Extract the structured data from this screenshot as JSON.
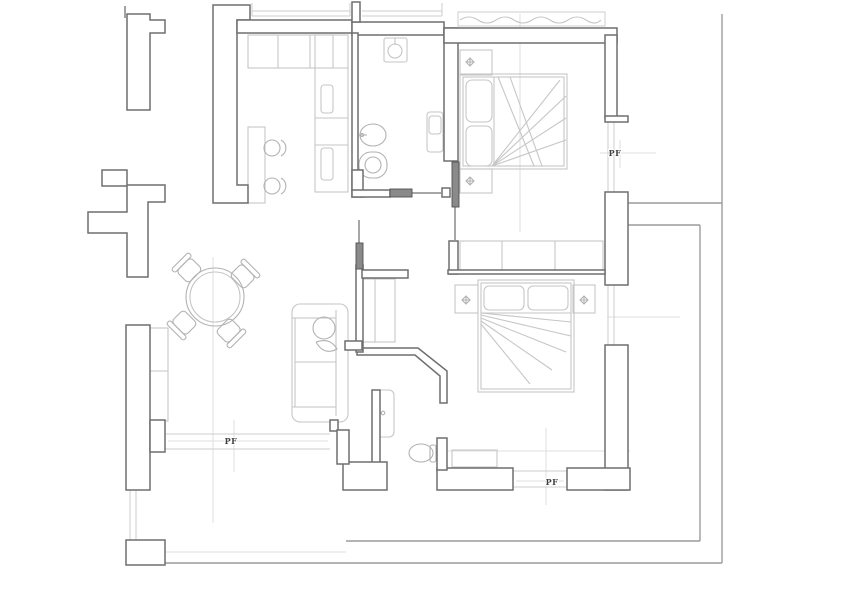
{
  "plan": {
    "type": "apartment-floor-plan",
    "labels": [
      {
        "text": "PF",
        "x": 615,
        "y": 156
      },
      {
        "text": "PF",
        "x": 231,
        "y": 444
      },
      {
        "text": "PF",
        "x": 552,
        "y": 485
      }
    ],
    "colors": {
      "background": "#ffffff",
      "wall_line": "#6f6f6f",
      "wall_fill": "#ffffff",
      "furniture_line": "#c6c6c6",
      "furniture_line_dark": "#b2b2b2",
      "door_fill": "#8a8a8a",
      "door_line": "#4f4f4f",
      "terrace_line": "#9c9c9c",
      "window_line": "#cccccc",
      "dimension_line": "#dfdfdf",
      "label_color": "#3f3f3f"
    }
  }
}
